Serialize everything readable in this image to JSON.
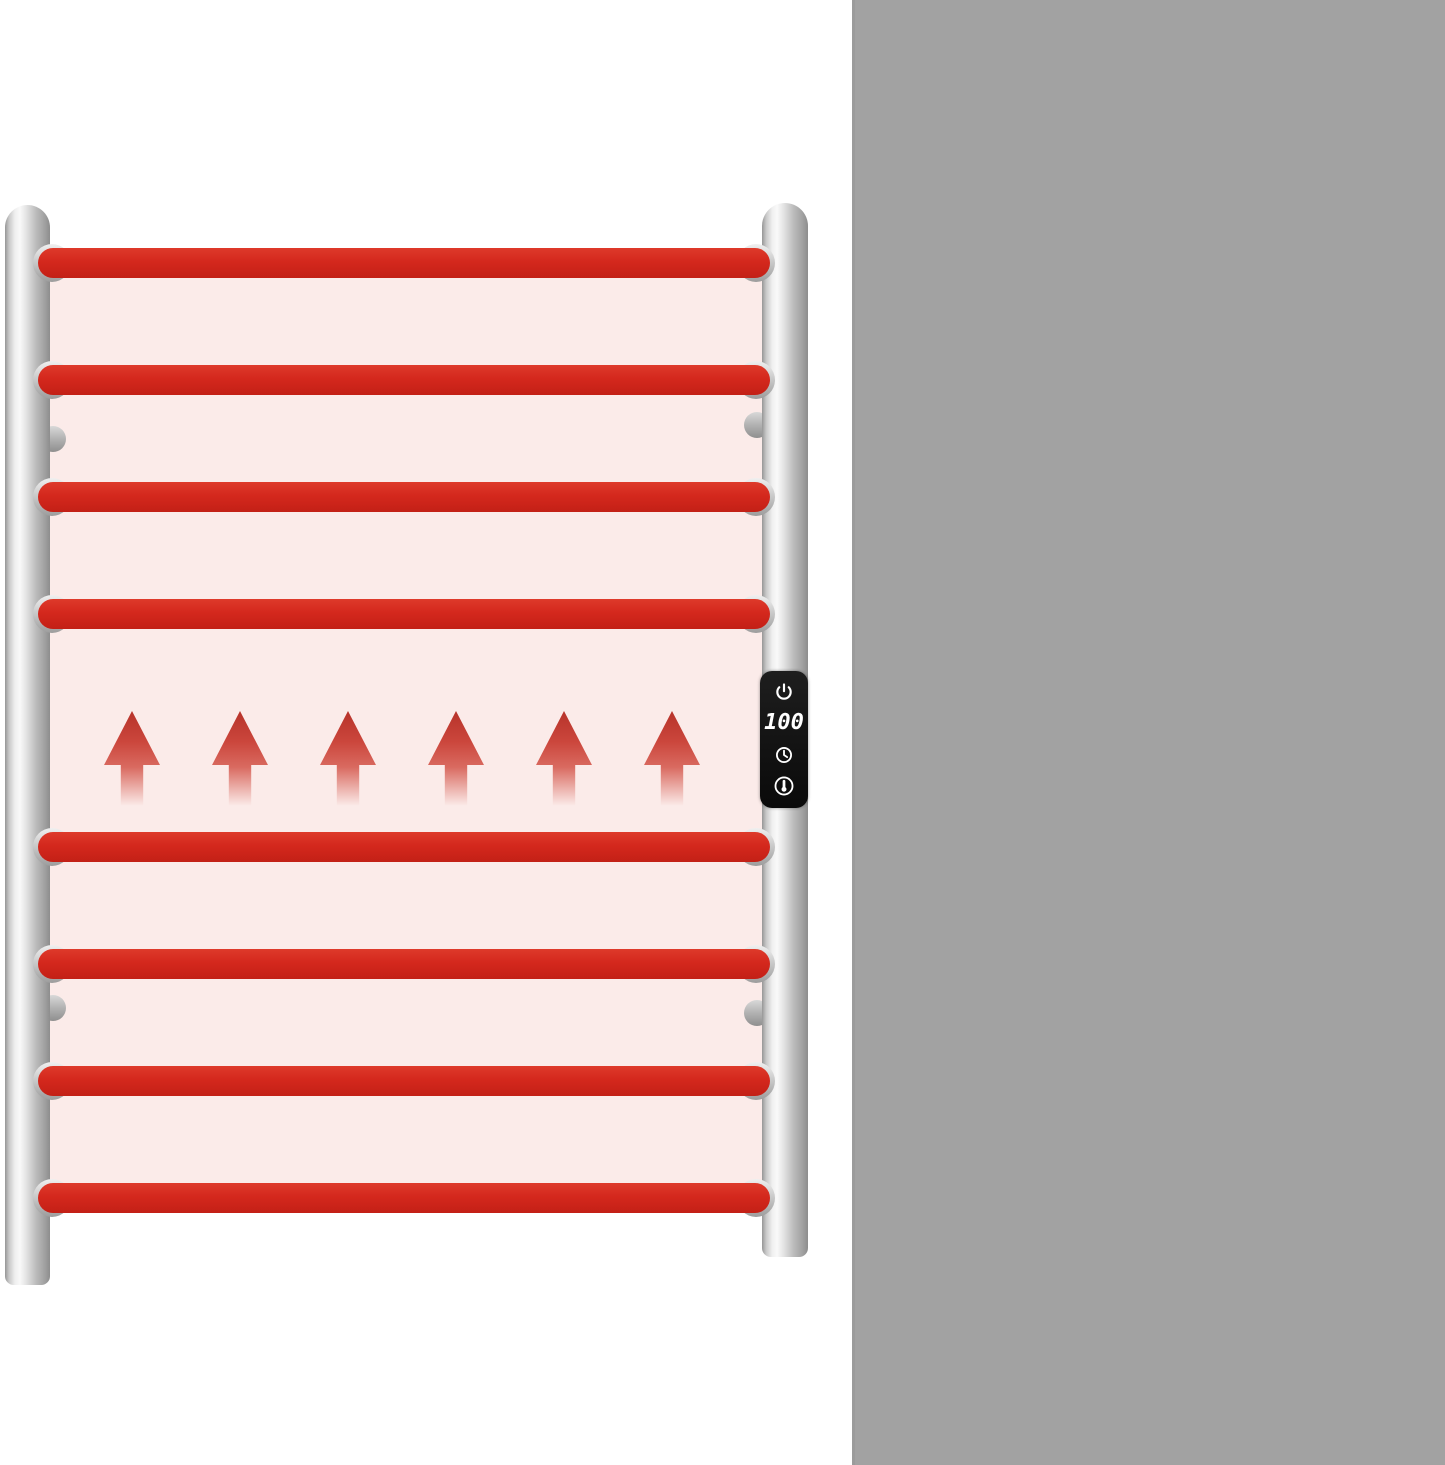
{
  "colors": {
    "panel_gray": "#a2a2a2",
    "rung_red": "#d4281d",
    "glow_pink": "#fbebe9",
    "text_white": "#ffffff",
    "control_panel_black": "#111111"
  },
  "towel_warmer": {
    "rung_count": 8,
    "arrow_count": 6,
    "control_panel": {
      "display_value": "100",
      "icons": [
        "power-icon",
        "timer-icon",
        "temperature-icon"
      ]
    }
  },
  "features": [
    {
      "id": "heat-time",
      "icon": "thermometer-icon",
      "time_value": "5",
      "time_unit": "min",
      "paren_open": "(",
      "temp_value": "104",
      "temp_unit": "℉",
      "paren_close": ")"
    },
    {
      "id": "heating-power",
      "icon": "heating-power-icon",
      "power_value": "105",
      "power_unit": "Watts",
      "label": "Heating Power"
    },
    {
      "id": "overheat-protection",
      "icon": "overheat-clock-icon",
      "line1": "Overheat",
      "line2": "Protection"
    },
    {
      "id": "wifi-connection",
      "icon": "wifi-icon",
      "line1": "WIFI",
      "line2": "Connection"
    }
  ]
}
